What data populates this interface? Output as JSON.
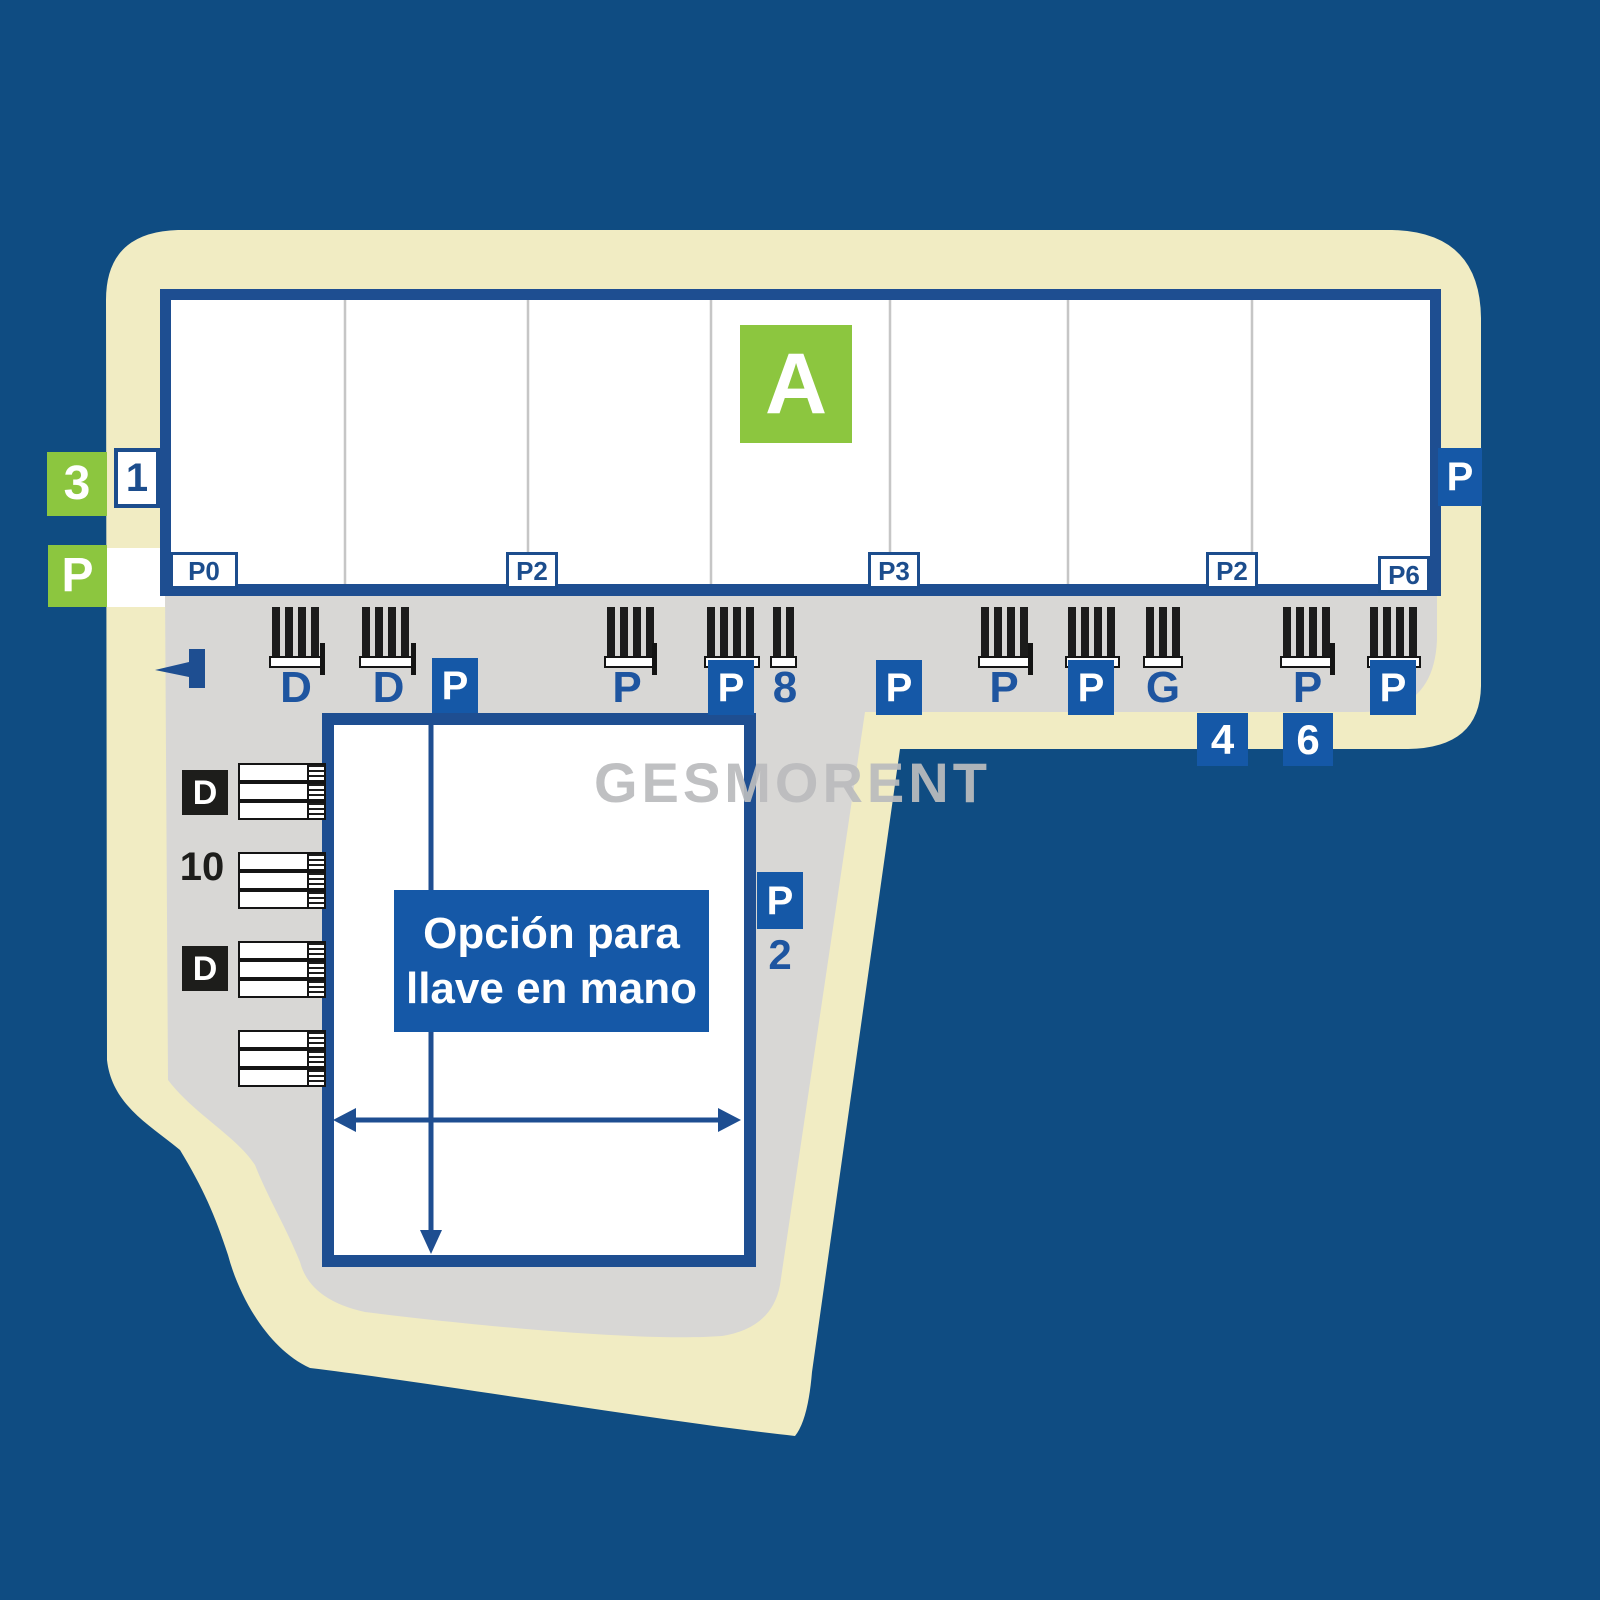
{
  "watermark": "GESMORENT",
  "plot": {
    "building_label": "A",
    "unit_left_label": "1",
    "left_badge_number": "3",
    "left_badge_parking": "P",
    "right_badge_parking": "P",
    "panel_labels": [
      "P0",
      "P2",
      "P3",
      "P2",
      "P6"
    ]
  },
  "parking_row": {
    "labels": [
      "D",
      "D",
      "P",
      "P",
      "P",
      "8",
      "P",
      "P",
      "P",
      "G",
      "P",
      "P"
    ],
    "bottom_badges": [
      "4",
      "6"
    ]
  },
  "left_docks": {
    "labels": [
      "D",
      "10",
      "D"
    ]
  },
  "keyhand_building": {
    "message_line1": "Opción para",
    "message_line2": "llave en mano",
    "side_badge": "P",
    "side_number": "2"
  },
  "colors": {
    "background": "#0f4c82",
    "plot_band": "#f1ecc3",
    "plaza": "#d8d7d5",
    "navy_border": "#1e4e91",
    "accent_blue": "#1558a7",
    "green": "#8cc63f",
    "label_navy": "#1c4d8d",
    "black": "#1d1d1b",
    "watermark_gray": "#bbbcbe",
    "white": "#ffffff"
  }
}
